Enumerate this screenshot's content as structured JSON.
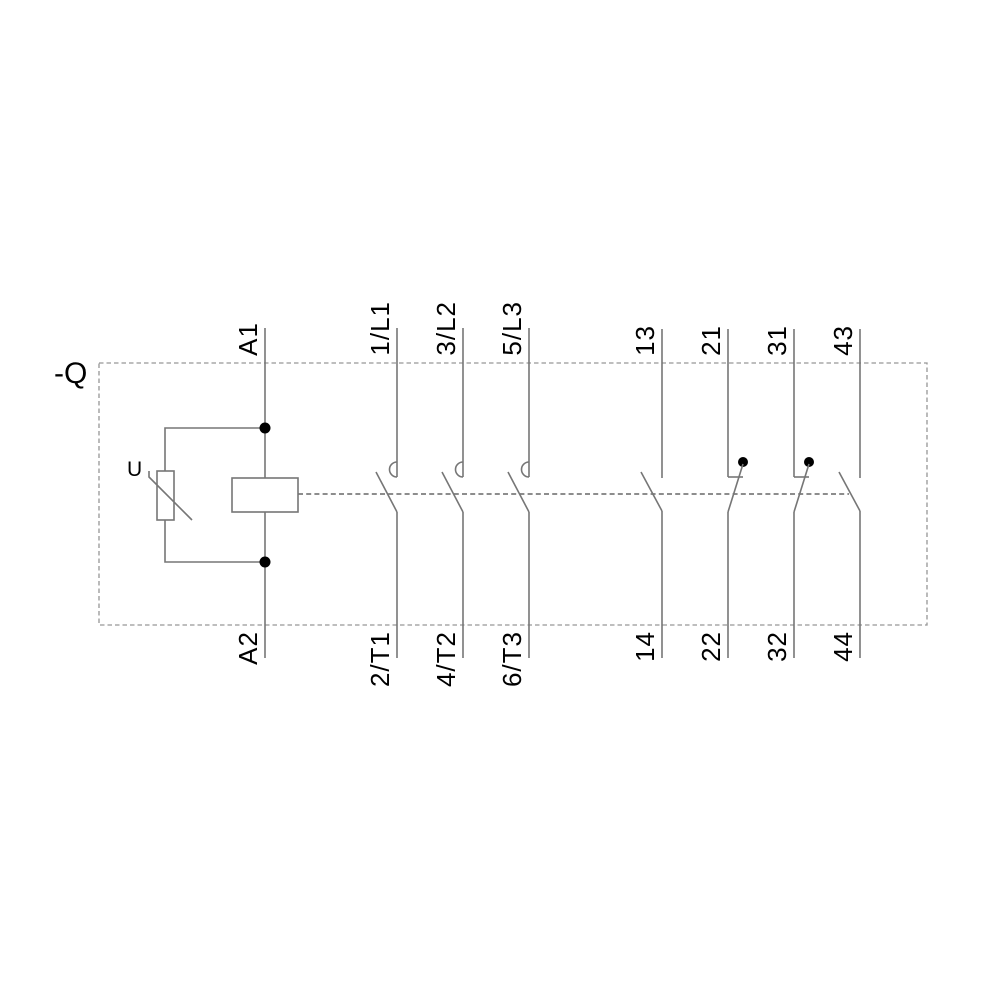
{
  "schematic": {
    "device_designation": "-Q",
    "varistor": {
      "label": "U"
    },
    "coil": {
      "top_terminal": "A1",
      "bottom_terminal": "A2"
    },
    "main_poles": [
      {
        "top": "1/L1",
        "bottom": "2/T1"
      },
      {
        "top": "3/L2",
        "bottom": "4/T2"
      },
      {
        "top": "5/L3",
        "bottom": "6/T3"
      }
    ],
    "aux_contacts": [
      {
        "top": "13",
        "bottom": "14",
        "type": "NO"
      },
      {
        "top": "21",
        "bottom": "22",
        "type": "NC"
      },
      {
        "top": "31",
        "bottom": "32",
        "type": "NC"
      },
      {
        "top": "43",
        "bottom": "44",
        "type": "NO"
      }
    ]
  },
  "colors": {
    "line": "#767676",
    "dashed_border": "#969696",
    "mechanical_link": "#8d8d8d",
    "text": "#000000",
    "junction_dot": "#000000",
    "background": "#ffffff"
  }
}
